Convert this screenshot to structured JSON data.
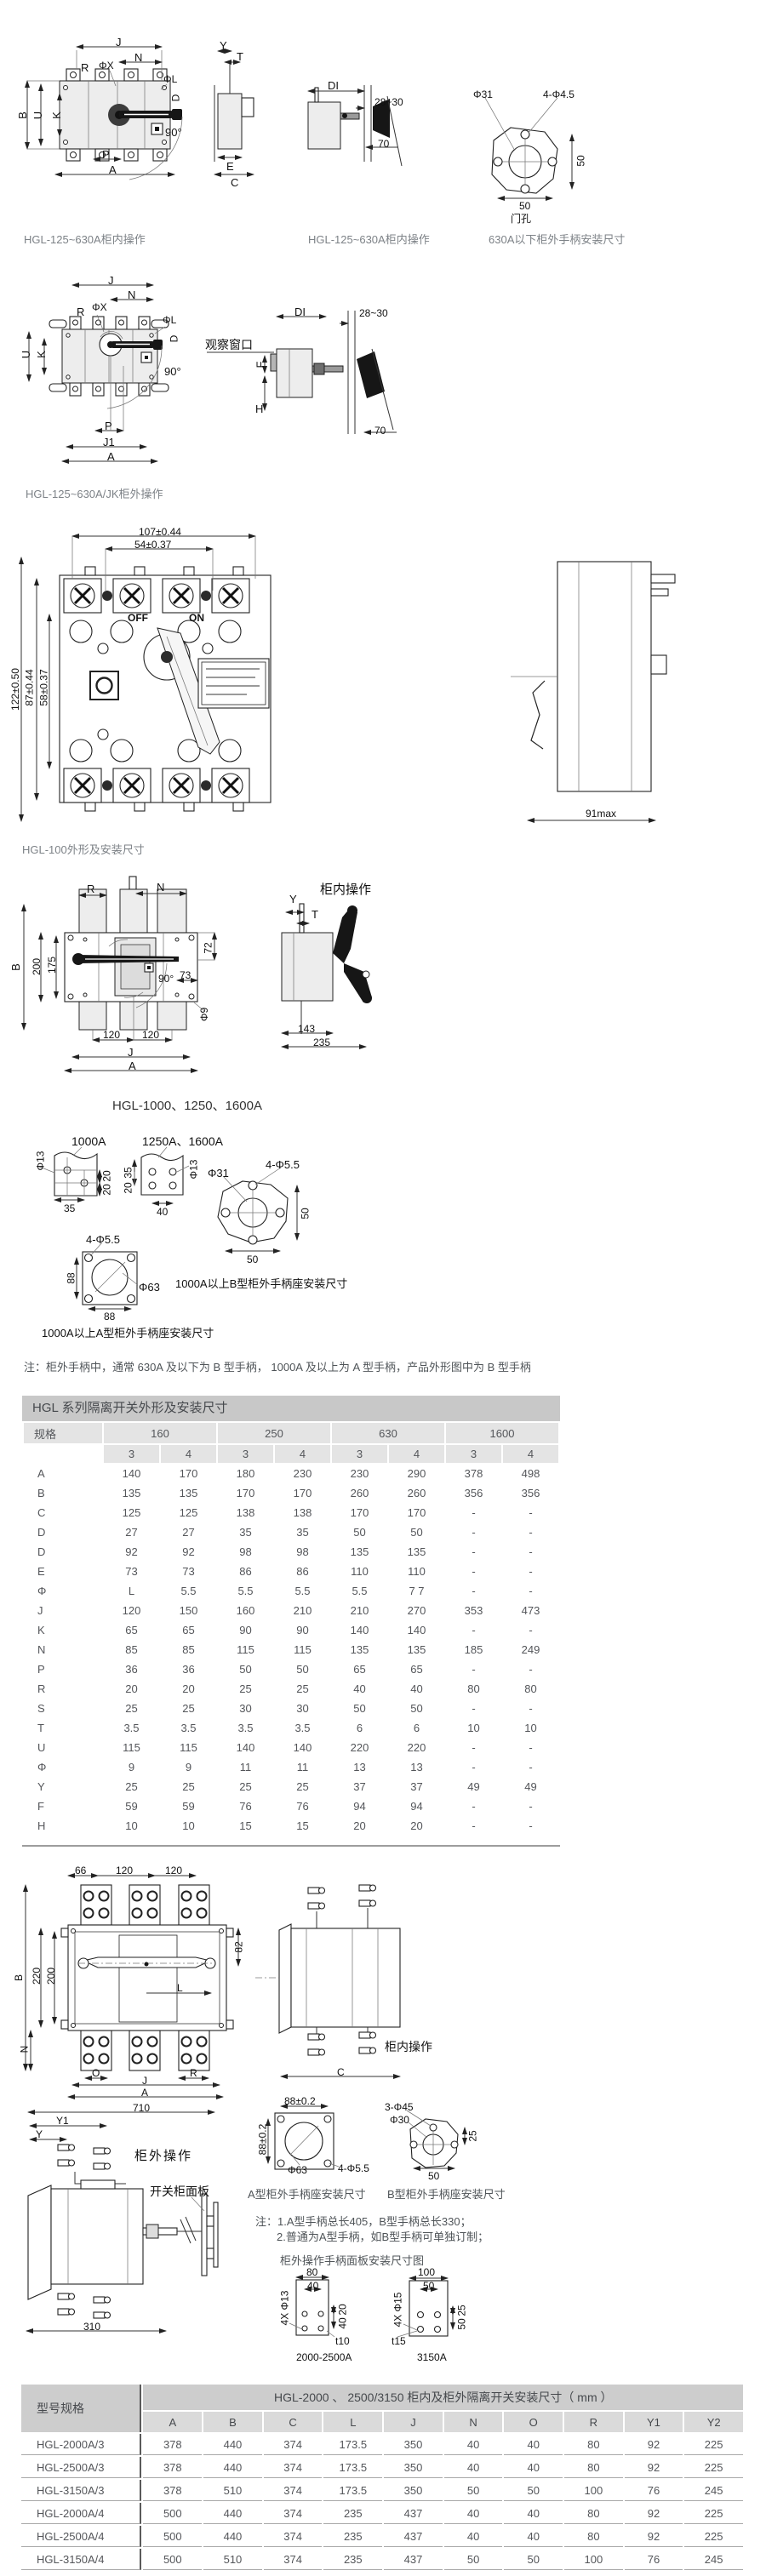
{
  "colors": {
    "accent_gray": "#c8c8c8",
    "header_gray": "#e4e4e4",
    "text_gray": "#54565a",
    "line": "#222222"
  },
  "row1": {
    "caption1": "HGL-125~630A柜内操作",
    "caption2": "HGL-125~630A柜内操作",
    "caption3": "630A以下柜外手柄安装尺寸",
    "labels": {
      "j": "J",
      "n": "N",
      "r": "R",
      "phix": "ΦX",
      "phil": "ΦL",
      "d": "D",
      "b": "B",
      "u": "U",
      "k": "K",
      "deg": "90°",
      "p": "P",
      "a": "A",
      "y": "Y",
      "t": "T",
      "e": "E",
      "c": "C",
      "di": "DI",
      "gap": "28~30",
      "d70": "70",
      "phi31": "Φ31",
      "holes": "4-Φ4.5",
      "d50v": "50",
      "d50h": "50",
      "menkong": "门孔"
    }
  },
  "row2": {
    "caption": "HGL-125~630A/JK柜外操作",
    "labels": {
      "j": "J",
      "n": "N",
      "r": "R",
      "phix": "ΦX",
      "phil": "ΦL",
      "d": "D",
      "u": "U",
      "k": "K",
      "deg": "90°",
      "p": "P",
      "j1": "J1",
      "a": "A",
      "window": "观察窗口",
      "di": "DI",
      "gap": "28~30",
      "f": "F",
      "h": "H",
      "d70": "70"
    }
  },
  "hgl100": {
    "caption": "HGL-100外形及安装尺寸",
    "labels": {
      "w1": "107±0.44",
      "w2": "54±0.37",
      "h1": "122±0.50",
      "h2": "87±0.44",
      "h3": "58±0.37",
      "off": "OFF",
      "on": "ON",
      "max": "91max"
    }
  },
  "hgl1000": {
    "caption": "HGL-1000、1250、1600A",
    "labels": {
      "r": "R",
      "n": "N",
      "b": "B",
      "d200": "200",
      "d175": "175",
      "d72": "72",
      "deg": "90°",
      "d73": "73",
      "phi9": "Φ9",
      "d120a": "120",
      "d120b": "120",
      "j": "J",
      "a": "A",
      "y": "Y",
      "t": "T",
      "d143": "143",
      "d235": "235",
      "panel": "柜内操作"
    }
  },
  "handles": {
    "label_1000": "1000A",
    "label_1250": "1250A、1600A",
    "caption_b": "1000A以上B型柜外手柄座安装尺寸",
    "caption_a": "1000A以上A型柜外手柄座安装尺寸",
    "labels": {
      "phi13a": "Φ13",
      "d35a": "35",
      "d20a": "20",
      "d20b": "20",
      "d35b": "35",
      "d20c": "20",
      "d40": "40",
      "phi13b": "Φ13",
      "phi31": "Φ31",
      "holes55a": "4-Φ5.5",
      "d50v": "50",
      "d50h": "50",
      "holes55b": "4-Φ5.5",
      "d88v": "88",
      "d88h": "88",
      "phi63": "Φ63"
    }
  },
  "note": "注：柜外手柄中，通常 630A 及以下为 B 型手柄， 1000A 及以上为 A 型手柄，产品外形图中为 B 型手柄",
  "main_table": {
    "title": "HGL 系列隔离开关外形及安装尺寸",
    "spec_label": "规格",
    "groups": [
      "160",
      "250",
      "630",
      "1600"
    ],
    "poles": [
      "3",
      "4",
      "3",
      "4",
      "3",
      "4",
      "3",
      "4"
    ],
    "rows": [
      {
        "label": "A",
        "values": [
          "140",
          "170",
          "180",
          "230",
          "230",
          "290",
          "378",
          "498"
        ]
      },
      {
        "label": "B",
        "values": [
          "135",
          "135",
          "170",
          "170",
          "260",
          "260",
          "356",
          "356"
        ]
      },
      {
        "label": "C",
        "values": [
          "125",
          "125",
          "138",
          "138",
          "170",
          "170",
          "-",
          "-"
        ]
      },
      {
        "label": "D",
        "values": [
          "27",
          "27",
          "35",
          "35",
          "50",
          "50",
          "-",
          "-"
        ]
      },
      {
        "label": "D",
        "values": [
          "92",
          "92",
          "98",
          "98",
          "135",
          "135",
          "-",
          "-"
        ]
      },
      {
        "label": "E",
        "values": [
          "73",
          "73",
          "86",
          "86",
          "110",
          "110",
          "-",
          "-"
        ]
      },
      {
        "label": "Φ",
        "values": [
          "L",
          "5.5",
          "5.5",
          "5.5",
          "5.5",
          "7 7",
          "-",
          "-"
        ]
      },
      {
        "label": "J",
        "values": [
          "120",
          "150",
          "160",
          "210",
          "210",
          "270",
          "353",
          "473"
        ]
      },
      {
        "label": "K",
        "values": [
          "65",
          "65",
          "90",
          "90",
          "140",
          "140",
          "-",
          "-"
        ]
      },
      {
        "label": "N",
        "values": [
          "85",
          "85",
          "115",
          "115",
          "135",
          "135",
          "185",
          "249"
        ]
      },
      {
        "label": "P",
        "values": [
          "36",
          "36",
          "50",
          "50",
          "65",
          "65",
          "-",
          "-"
        ]
      },
      {
        "label": "R",
        "values": [
          "20",
          "20",
          "25",
          "25",
          "40",
          "40",
          "80",
          "80"
        ]
      },
      {
        "label": "S",
        "values": [
          "25",
          "25",
          "30",
          "30",
          "50",
          "50",
          "-",
          "-"
        ]
      },
      {
        "label": "T",
        "values": [
          "3.5",
          "3.5",
          "3.5",
          "3.5",
          "6",
          "6",
          "10",
          "10"
        ]
      },
      {
        "label": "U",
        "values": [
          "115",
          "115",
          "140",
          "140",
          "220",
          "220",
          "-",
          "-"
        ]
      },
      {
        "label": "Φ",
        "values": [
          "9",
          "9",
          "11",
          "11",
          "13",
          "13",
          "-",
          "-"
        ]
      },
      {
        "label": "Y",
        "values": [
          "25",
          "25",
          "25",
          "25",
          "37",
          "37",
          "49",
          "49"
        ]
      },
      {
        "label": "F",
        "values": [
          "59",
          "59",
          "76",
          "76",
          "94",
          "94",
          "-",
          "-"
        ]
      },
      {
        "label": "H",
        "values": [
          "10",
          "10",
          "15",
          "15",
          "20",
          "20",
          "-",
          "-"
        ]
      }
    ]
  },
  "bottom_drawings": {
    "front": {
      "d66": "66",
      "d120a": "120",
      "d120b": "120",
      "b": "B",
      "d220": "220",
      "d200": "200",
      "d82": "82",
      "n": "N",
      "o": "O",
      "r": "R",
      "l": "L",
      "j": "J",
      "a": "A",
      "d710": "710"
    },
    "side": {
      "c": "C",
      "panel_in": "柜内操作"
    },
    "lower": {
      "y1": "Y1",
      "y": "Y",
      "panel_out": "柜外操作",
      "panel_board": "开关柜面板",
      "d310": "310"
    },
    "seat_a": {
      "w": "88±0.2",
      "h": "88±0.2",
      "phi63": "Φ63",
      "holes": "4-Φ5.5",
      "caption": "A型柜外手柄座安装尺寸"
    },
    "seat_b": {
      "holes": "3-Φ45",
      "phi30": "Φ30",
      "d25": "25",
      "d50": "50",
      "caption": "B型柜外手柄座安装尺寸"
    },
    "note1": "注：1.A型手柄总长405，B型手柄总长330；",
    "note2": "2.普通为A型手柄，如B型手柄可单独订制；",
    "panel_title": "柜外操作手柄面板安装尺寸图",
    "panel1": {
      "w": "80",
      "w2": "40",
      "h": "20",
      "h2": "40",
      "holes": "4X Φ13",
      "t": "t10",
      "caption": "2000-2500A"
    },
    "panel2": {
      "w": "100",
      "w2": "50",
      "h": "25",
      "h2": "50",
      "holes": "4X Φ15",
      "t": "t15",
      "caption": "3150A"
    }
  },
  "bottom_table": {
    "col1_header": "型号规格",
    "title": "HGL-2000 、 2500/3150 柜内及柜外隔离开关安装尺寸（ mm ）",
    "columns": [
      "A",
      "B",
      "C",
      "L",
      "J",
      "N",
      "O",
      "R",
      "Y1",
      "Y2"
    ],
    "rows": [
      {
        "model": "HGL-2000A/3",
        "values": [
          "378",
          "440",
          "374",
          "173.5",
          "350",
          "40",
          "40",
          "80",
          "92",
          "225"
        ]
      },
      {
        "model": "HGL-2500A/3",
        "values": [
          "378",
          "440",
          "374",
          "173.5",
          "350",
          "40",
          "40",
          "80",
          "92",
          "225"
        ]
      },
      {
        "model": "HGL-3150A/3",
        "values": [
          "378",
          "510",
          "374",
          "173.5",
          "350",
          "50",
          "50",
          "100",
          "76",
          "245"
        ]
      },
      {
        "model": "HGL-2000A/4",
        "values": [
          "500",
          "440",
          "374",
          "235",
          "437",
          "40",
          "40",
          "80",
          "92",
          "225"
        ]
      },
      {
        "model": "HGL-2500A/4",
        "values": [
          "500",
          "440",
          "374",
          "235",
          "437",
          "40",
          "40",
          "80",
          "92",
          "225"
        ]
      },
      {
        "model": "HGL-3150A/4",
        "values": [
          "500",
          "510",
          "374",
          "235",
          "437",
          "50",
          "50",
          "100",
          "76",
          "245"
        ]
      }
    ]
  }
}
